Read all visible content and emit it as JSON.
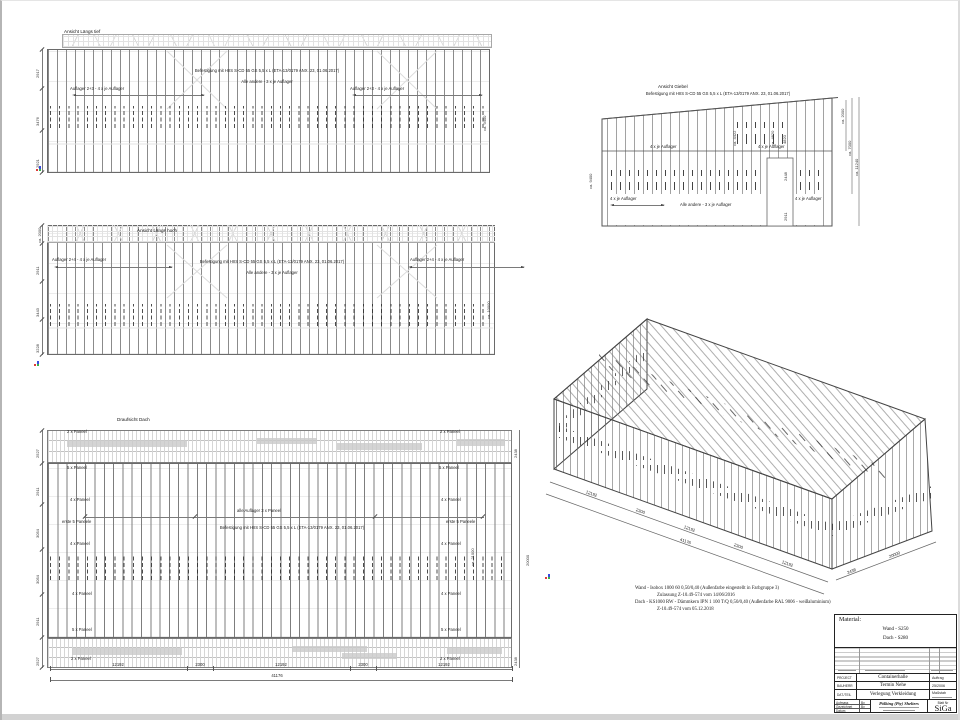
{
  "common": {
    "note_fix": "Befestigung mit HIIS S-CD 55 GS 5,5 x L (ETA-13/0179 ANX. 23, 01.06.2017)",
    "note_other": "Alle andere - 3 x je Auflager"
  },
  "v1": {
    "title": "Ansicht Längs tief",
    "auf_l": "Auflager 2+3 - 4 x je Auflager",
    "auf_r": "Auflager 2+3 - 4 x je Auflager",
    "d1": "2917",
    "d2": "3476",
    "d3": "2921",
    "dr": "ca. 9400"
  },
  "v2": {
    "title": "Ansicht Längs hoch",
    "auf_l": "Auflager 2+4 - 4 x je Auflager",
    "auf_r": "Auflager 2+4 - 4 x je Auflager",
    "dt": "ca. 2000",
    "d1": "2911",
    "d2": "3443",
    "d3": "3228",
    "dr": "ca. 10000"
  },
  "v3": {
    "title": "Draufsicht Dach",
    "p2": "2 x Paneel",
    "p5": "5 x Paneel",
    "p4": "4 x Paneel",
    "erste": "erste 5 Paneele",
    "alle": "alle Auflager 3 x Paneel",
    "dl": [
      "2527",
      "2911",
      "3054",
      "3054",
      "2911",
      "2527"
    ],
    "d2438": "2438",
    "d20000": "20000",
    "d21000": "ca. 21000",
    "db": [
      "12192",
      "2300",
      "12192",
      "2300",
      "12192"
    ],
    "dtotal": "41176"
  },
  "g": {
    "title": "Ansicht Giebel",
    "auf4": "4 x je Auflager",
    "dl": "ca. 9400",
    "da": "ca. 4422",
    "db": "ca. 4820",
    "dc": "4820",
    "dr1": "ca. 2000",
    "dr2": "ca. 7000",
    "dr3": "ca. 11240",
    "dd1": "2448",
    "dd2": "2911"
  },
  "iso": {
    "db": [
      "12192",
      "2300",
      "12192",
      "2300",
      "12192"
    ],
    "dtotal": "41176",
    "dr": [
      "2438",
      "20000"
    ]
  },
  "notes": {
    "l1": "Wand  -  Isobox 1000 60 0,50/0,40 (Außenfarbe eingestellt in Farbgruppe 3)",
    "l2": "Zulassung  Z-10.49-574 vom 14/06/2016",
    "l3": "Dach  -  KS1000 RW - Dämmkern IPN 1 100 T/Q 0,50/0,40 (Außenfarbe RAL 9006 - weißaluminium)",
    "l4": "Z-10.49-574 vom 05.12.2018"
  },
  "tb": {
    "material": "Material:",
    "wand": "Wand  -  S250",
    "dach": "Dach  -  S280",
    "r1l": "PROJECT",
    "r1v": "Containerhalle",
    "r1r": "Auftrag",
    "r2l": "BAUHERR",
    "r2v": "Termin Nehe",
    "r2r": "25/2006",
    "r3l": "DAT./TEIL",
    "r3v": "Verlegung Verkleidung",
    "r3r": "Maßstab",
    "s1l": "Aufmass",
    "s1r": "By",
    "s2l": "Gezeichnet",
    "s2r": "By",
    "s3l": "Datum",
    "s3r": "",
    "company": "Pölking (Pty) Shelters",
    "blatt": "Blatt Nr",
    "sheet": "SiGa"
  }
}
